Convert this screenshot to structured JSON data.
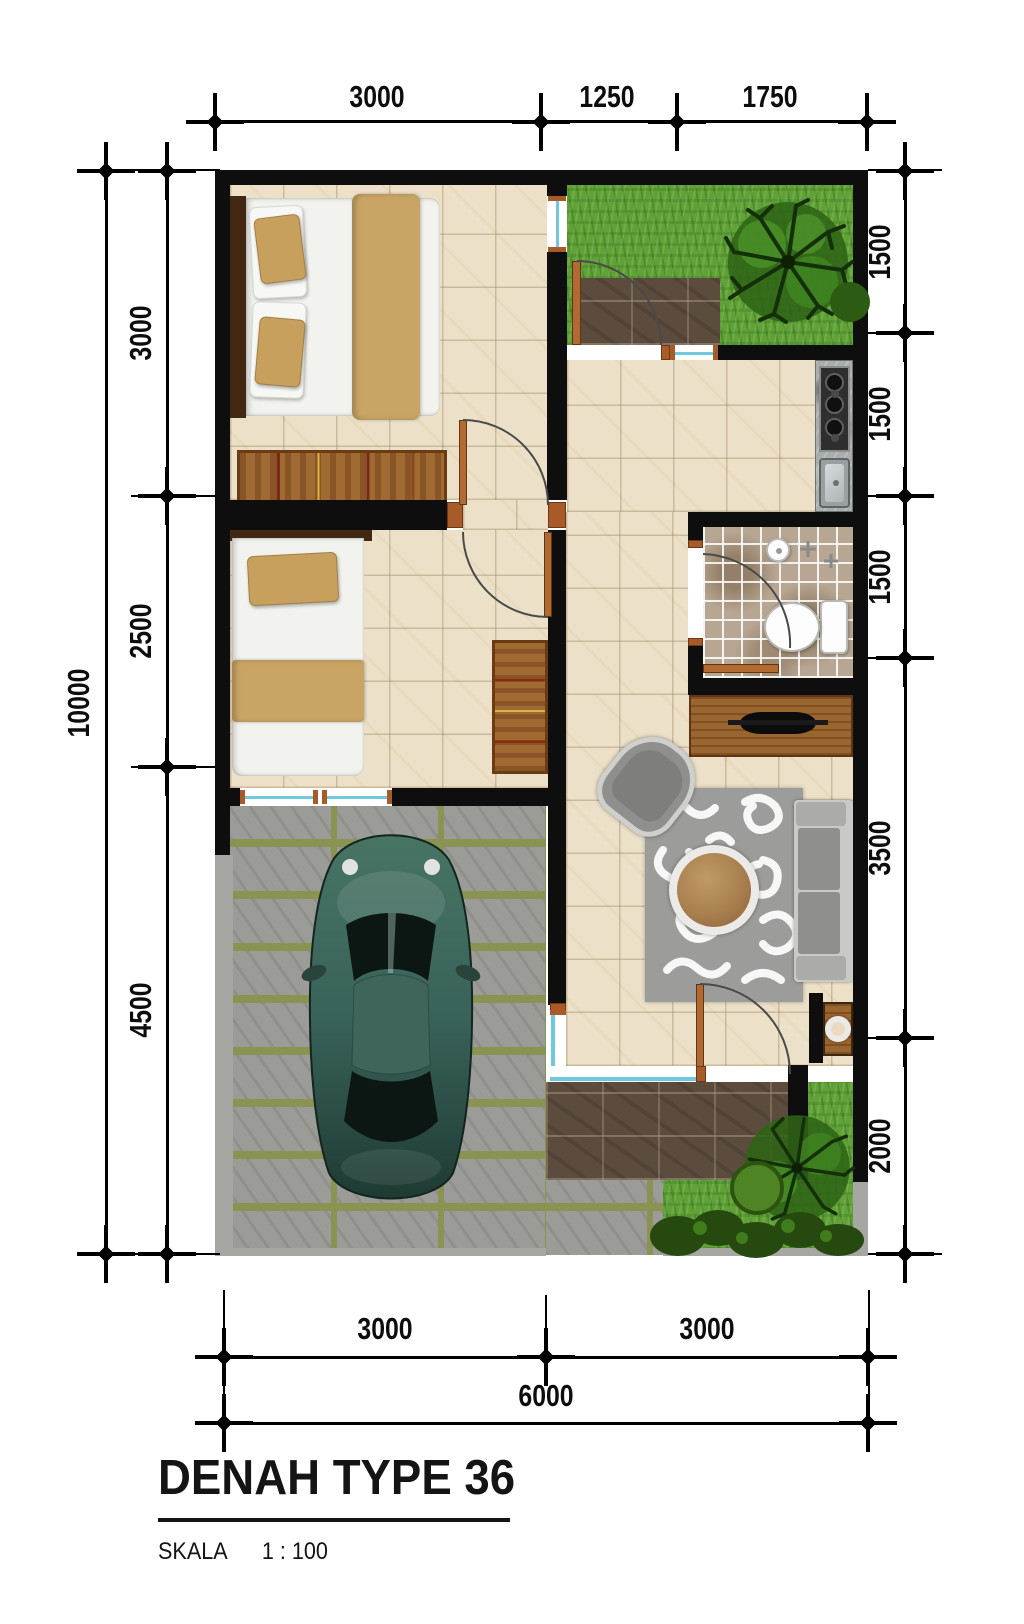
{
  "title_block": {
    "title": "DENAH TYPE 36",
    "scale_label": "SKALA",
    "scale_ratio": "1 : 100"
  },
  "dimensions_mm": {
    "top": [
      "3000",
      "1250",
      "1750"
    ],
    "left_total": "10000",
    "left": [
      "3000",
      "2500",
      "4500"
    ],
    "right": [
      "1500",
      "1500",
      "1500",
      "3500",
      "2000"
    ],
    "bottom": [
      "3000",
      "3000"
    ],
    "bottom_total": "6000"
  },
  "colors": {
    "wall": "#0e0e0e",
    "floor_tile": "#ece1c8",
    "bath_tile": "#b7a792",
    "grass": "#61a236",
    "terrace_tile": "#5c4c3e",
    "paving": "#9b9b97",
    "wood": "#9a6630",
    "door_jamb": "#a85a28",
    "window_glass": "#6fc8de",
    "car_body": "#3f6b5c",
    "sofa": "#8f8f8d"
  }
}
